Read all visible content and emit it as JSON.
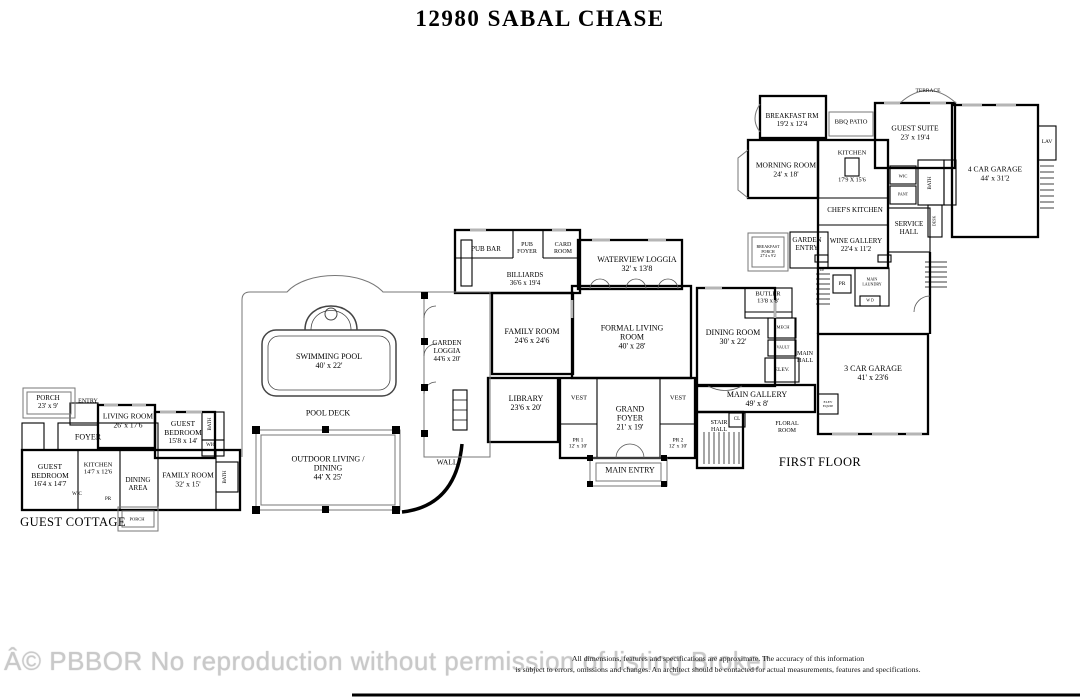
{
  "title": "12980 SABAL CHASE",
  "area_labels": {
    "first_floor": "FIRST FLOOR",
    "guest_cottage": "GUEST COTTAGE"
  },
  "rooms": {
    "porch_cottage": {
      "name": "PORCH",
      "dims": "23' x 9'"
    },
    "entry": {
      "name": "ENTRY"
    },
    "living_room": {
      "name": "LIVING ROOM",
      "dims": "26' x 17'6"
    },
    "guest_bedroom_1": {
      "name": "GUEST BEDROOM",
      "dims": "15'8 x 14'"
    },
    "foyer": {
      "name": "FOYER"
    },
    "guest_bedroom_2": {
      "name": "GUEST BEDROOM",
      "dims": "16'4 x 14'7"
    },
    "kitchen_cottage": {
      "name": "KITCHEN",
      "dims": "14'7 x 12'6"
    },
    "dining_area": {
      "name": "DINING AREA"
    },
    "family_room_cottage": {
      "name": "FAMILY ROOM",
      "dims": "32' x 15'"
    },
    "wic_cottage": {
      "name": "WIC"
    },
    "pr_cottage": {
      "name": "PR"
    },
    "porch_bottom": {
      "name": "PORCH"
    },
    "bath_cottage_1": {
      "name": "BATH"
    },
    "wic_cottage_right": {
      "name": "WIC"
    },
    "bath_cottage_2": {
      "name": "BATH"
    },
    "swimming_pool": {
      "name": "SWIMMING POOL",
      "dims": "40' x 22'"
    },
    "pool_deck": {
      "name": "POOL DECK"
    },
    "outdoor_living": {
      "name": "OUTDOOR LIVING / DINING",
      "dims": "44' X 25'"
    },
    "wall": {
      "name": "WALL"
    },
    "garden_loggia": {
      "name": "GARDEN LOGGIA",
      "dims": "44'6 x 20'"
    },
    "pub_bar": {
      "name": "PUB BAR"
    },
    "pub_foyer": {
      "name": "PUB FOYER"
    },
    "card_room": {
      "name": "CARD ROOM"
    },
    "billiards": {
      "name": "BILLIARDS",
      "dims": "36'6 x 19'4"
    },
    "family_room": {
      "name": "FAMILY ROOM",
      "dims": "24'6 x 24'6"
    },
    "waterview_loggia": {
      "name": "WATERVIEW LOGGIA",
      "dims": "32' x 13'8"
    },
    "formal_living": {
      "name": "FORMAL LIVING ROOM",
      "dims": "40' x 28'"
    },
    "library": {
      "name": "LIBRARY",
      "dims": "23'6 x 20'"
    },
    "vest_left": {
      "name": "VEST"
    },
    "vest_right": {
      "name": "VEST"
    },
    "grand_foyer": {
      "name": "GRAND FOYER",
      "dims": "21' x 19'"
    },
    "pr1": {
      "name": "PR 1",
      "dims": "12' x 10'"
    },
    "pr2": {
      "name": "PR 2",
      "dims": "12' x 10'"
    },
    "main_entry": {
      "name": "MAIN ENTRY"
    },
    "dining_room": {
      "name": "DINING ROOM",
      "dims": "30' x 22'"
    },
    "butler": {
      "name": "BUTLER",
      "dims": "13'8 x 8'"
    },
    "mech": {
      "name": "MECH"
    },
    "vault": {
      "name": "VAULT"
    },
    "main_hall": {
      "name": "MAIN HALL"
    },
    "elev": {
      "name": "ELEV."
    },
    "elev_equip": {
      "name": "ELEV EQUIP"
    },
    "main_gallery": {
      "name": "MAIN GALLERY",
      "dims": "49' x 8'"
    },
    "stair_hall": {
      "name": "STAIR HALL"
    },
    "cl": {
      "name": "CL"
    },
    "floral_room": {
      "name": "FLORAL ROOM"
    },
    "garage3": {
      "name": "3 CAR GARAGE",
      "dims": "41' x 23'6"
    },
    "terrace": {
      "name": "TERRACE"
    },
    "breakfast_rm": {
      "name": "BREAKFAST RM",
      "dims": "19'2 x 12'4"
    },
    "bbq_patio": {
      "name": "BBQ PATIO"
    },
    "guest_suite": {
      "name": "GUEST SUITE",
      "dims": "23' x 19'4"
    },
    "garage4": {
      "name": "4 CAR GARAGE",
      "dims": "44' x 31'2"
    },
    "lav": {
      "name": "LAV"
    },
    "morning_room": {
      "name": "MORNING ROOM",
      "dims": "24' x 18'"
    },
    "kitchen_main": {
      "name": "KITCHEN",
      "dims": "17'9 X 15'6"
    },
    "wic_main": {
      "name": "WIC"
    },
    "pant": {
      "name": "PANT"
    },
    "bath_main": {
      "name": "BATH"
    },
    "chefs_kitchen": {
      "name": "CHEF'S KITCHEN"
    },
    "service_hall": {
      "name": "SERVICE HALL"
    },
    "desk": {
      "name": "DESK"
    },
    "garden_entry": {
      "name": "GARDEN ENTRY"
    },
    "wine_gallery": {
      "name": "WINE GALLERY",
      "dims": "22'4 x 11'2"
    },
    "breakfast_porch": {
      "name": "BREAKFAST PORCH",
      "dims": "27'4 x 9'2"
    },
    "up": {
      "name": "UP"
    },
    "pr_main": {
      "name": "PR"
    },
    "main_laundry": {
      "name": "MAIN LAUNDRY"
    },
    "wd": {
      "name": "W D"
    }
  },
  "footer": {
    "watermark": "Â© PBBOR No reproduction without permission of listing Broker",
    "disclaimer_line1": "All dimensions, features and specifications are approximate. The accuracy of this information",
    "disclaimer_line2": "is subject to errors, omissions and changes. An architect should be contacted for actual measurements, features and specifications."
  },
  "colors": {
    "walls": "#000000",
    "thin_lines": "#777777",
    "watermark": "#c9c9c9"
  }
}
